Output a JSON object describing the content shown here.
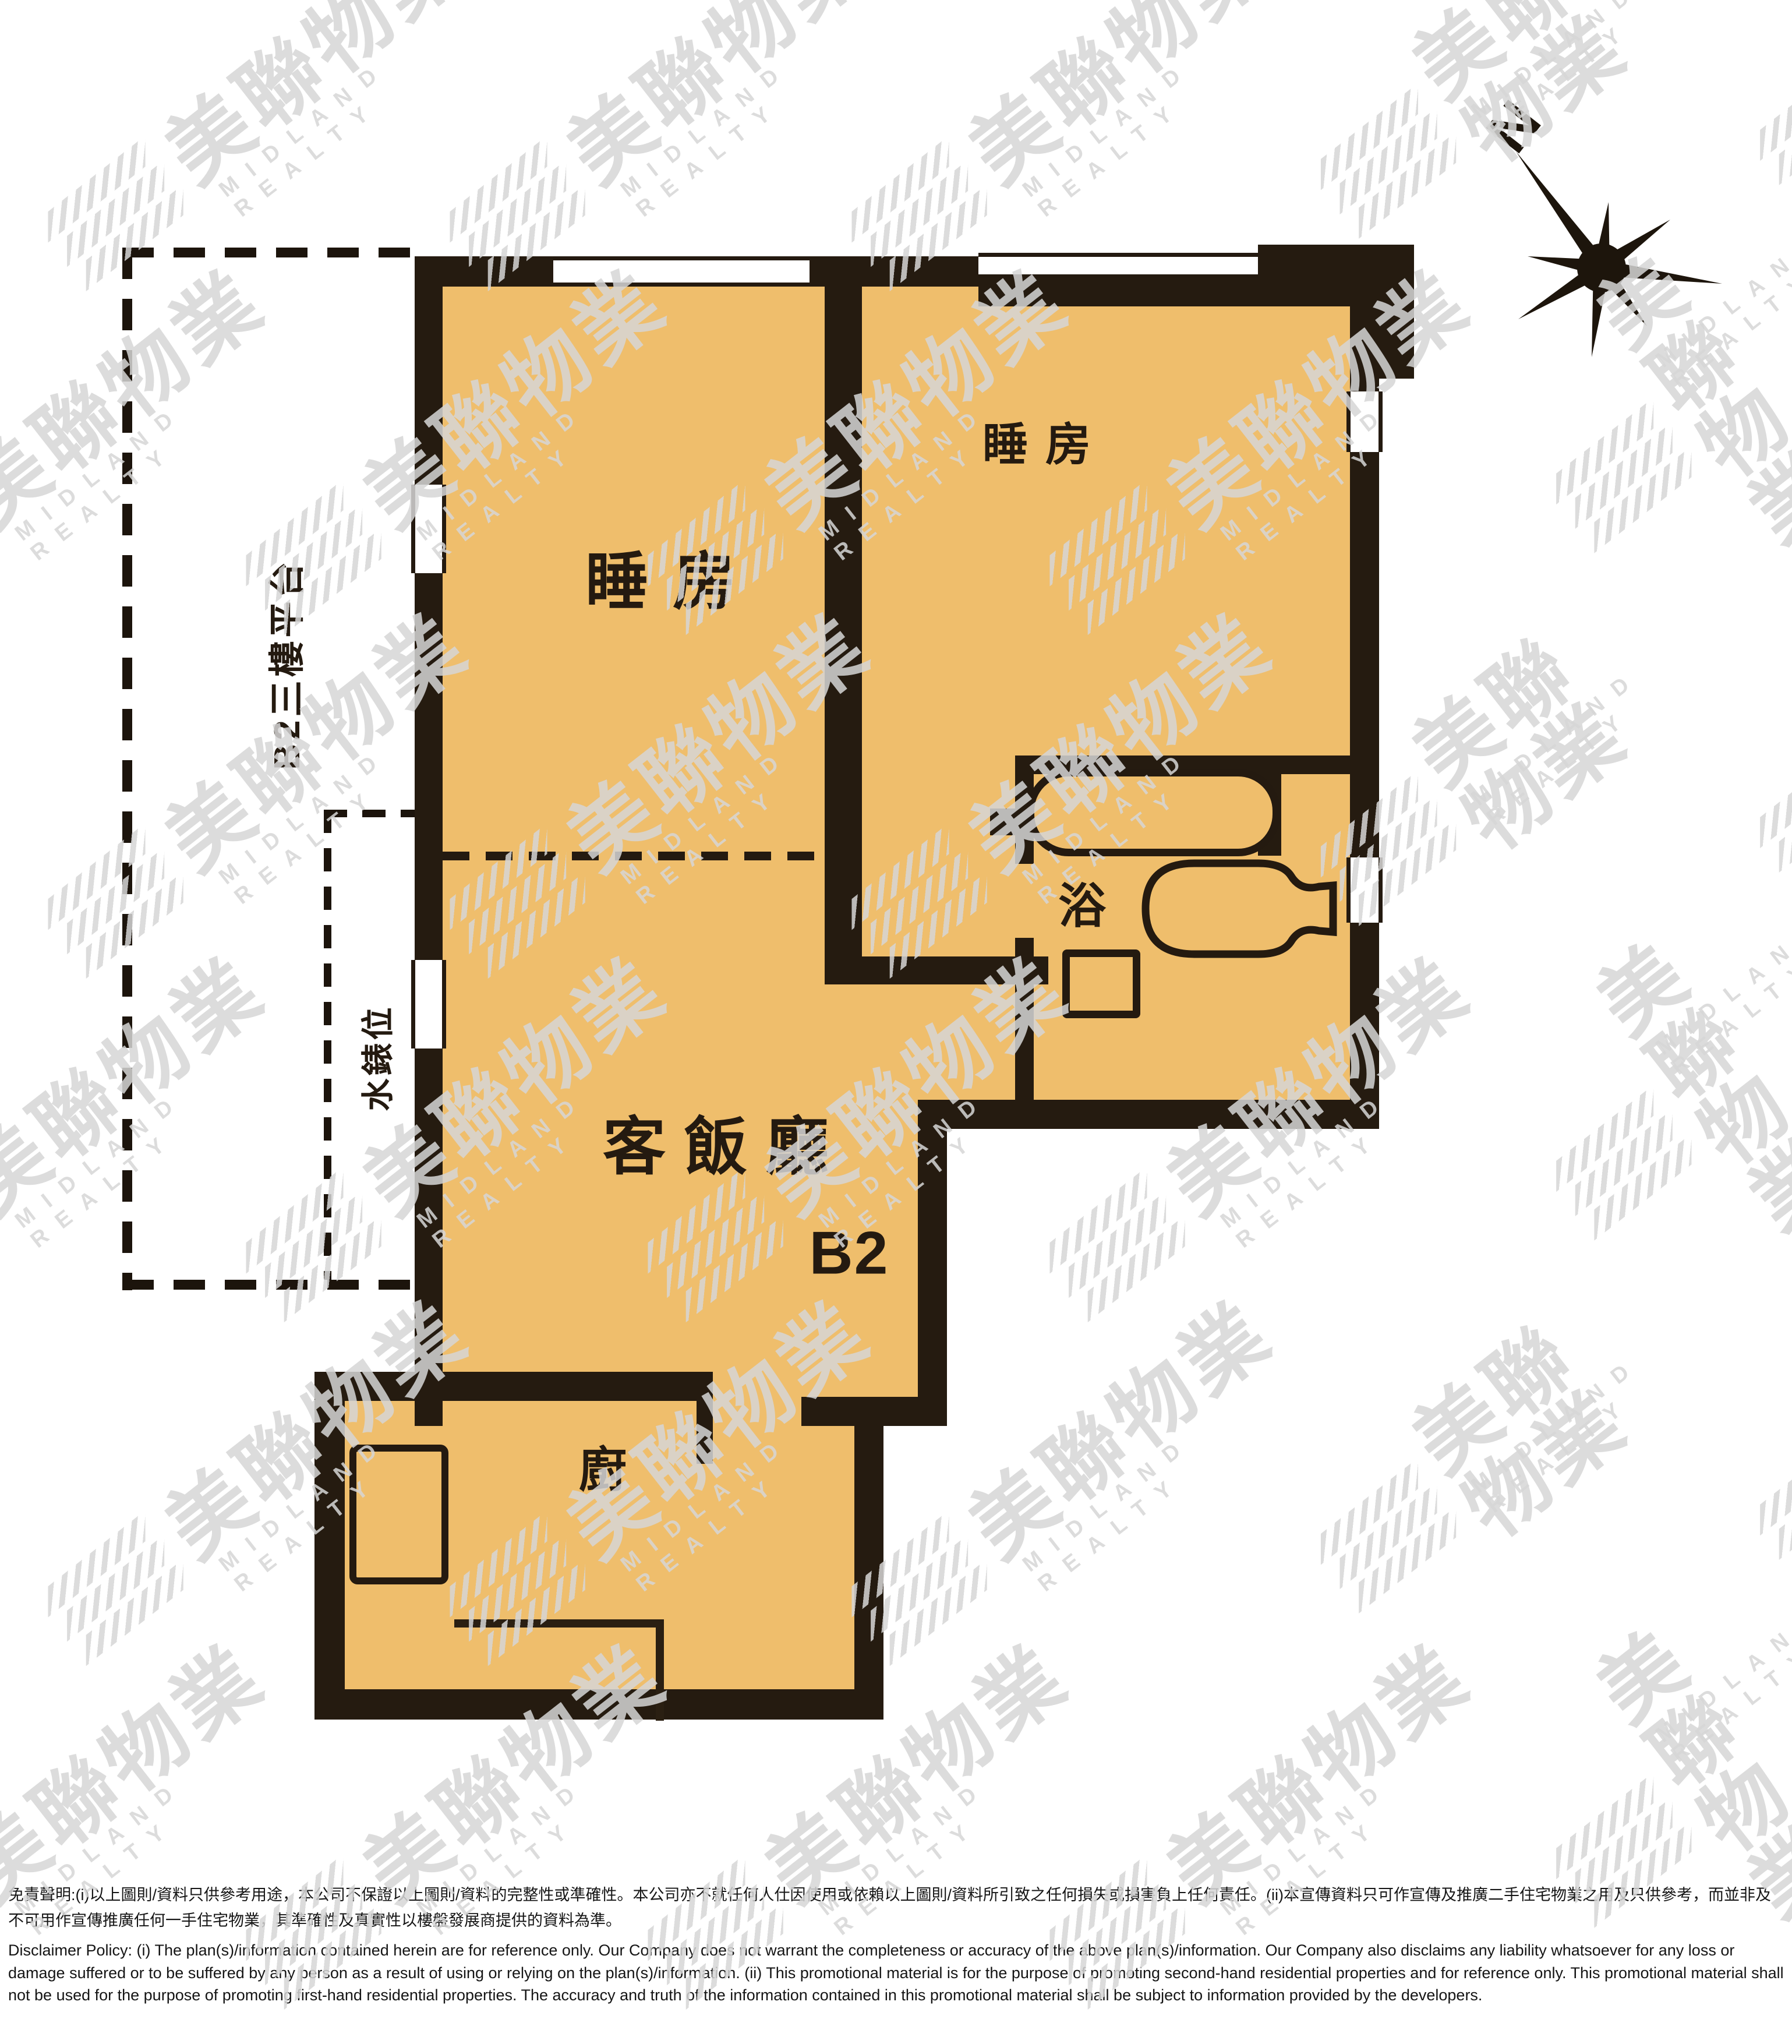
{
  "plan": {
    "unit_label": "B2",
    "compass": {
      "north_label": "N"
    },
    "rooms": {
      "bedroom_1": "睡房",
      "bedroom_2": "睡房",
      "living_dining": "客飯廳",
      "bathroom": "浴",
      "kitchen": "廚"
    },
    "outdoor": {
      "platform": "B2三樓平台",
      "water_meter": "水錶位"
    }
  },
  "watermark": {
    "cjk": "美聯物業",
    "latin": "MIDLAND REALTY"
  },
  "disclaimer": {
    "zh": "免責聲明:(i)以上圖則/資料只供參考用途，本公司不保證以上圖則/資料的完整性或準確性。本公司亦不就任何人仕因使用或依賴以上圖則/資料所引致之任何損失或損害負上任何責任。(ii)本宣傳資料只可作宣傳及推廣二手住宅物業之用及只供參考，而並非及不可用作宣傳推廣任何一手住宅物業，其準確性及真實性以樓盤發展商提供的資料為準。",
    "en": "Disclaimer Policy: (i) The plan(s)/information contained herein are for reference only. Our Company does not warrant the completeness or accuracy of the above plan(s)/information. Our Company also disclaims any liability whatsoever for any loss or damage suffered or to be suffered by any person as a result of using or relying on the plan(s)/information. (ii) This promotional material is for the purpose of promoting second-hand residential properties and for reference only. This promotional material shall not be used for the purpose of promoting first-hand residential properties. The accuracy and truth of the information contained in this promotional material shall be subject to information provided by the developers."
  },
  "colors": {
    "floor_fill": "#efbe6c",
    "wall": "#251b10",
    "watermark": "#d6d6d6",
    "label_text": "#241a10"
  }
}
